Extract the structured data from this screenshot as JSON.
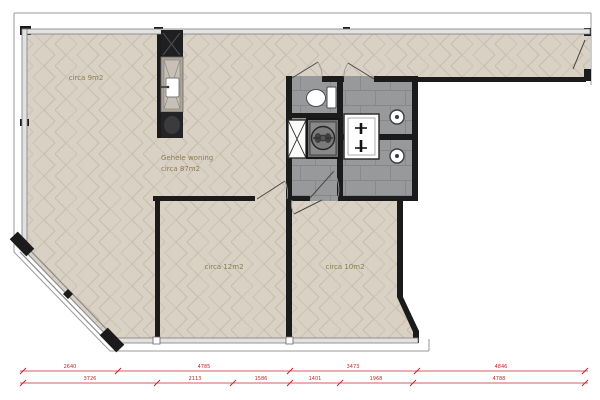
{
  "plan": {
    "type": "floor-plan",
    "language": "nl",
    "rooms": [
      {
        "id": "area-top-left",
        "label": "circa 9m2"
      },
      {
        "id": "whole-home",
        "label_line1": "Gehele woning",
        "label_line2": "circa 87m2"
      },
      {
        "id": "bedroom-left",
        "label": "circa 12m2"
      },
      {
        "id": "bedroom-right",
        "label": "circa 10m2"
      }
    ],
    "fixtures": [
      "kitchen-unit",
      "toilet",
      "linen-cupboard",
      "washing-machine",
      "double-washbasin",
      "shower-head",
      "shower-head"
    ],
    "colors": {
      "wall": "#1b1b1b",
      "wood_floor": "#d9d1c4",
      "wood_joint": "#c8bdae",
      "tile_floor": "#97999b",
      "tile_joint": "#85878a",
      "room_label": "#8b7c50",
      "dimension_red": "#c0272d",
      "window_wall": "#e2e2e2"
    },
    "dimensions": {
      "row1": [
        "2640",
        "4785",
        "3473",
        "4846"
      ],
      "row2": [
        "3726",
        "2113",
        "1586",
        "1401",
        "1968",
        "4788"
      ]
    }
  }
}
